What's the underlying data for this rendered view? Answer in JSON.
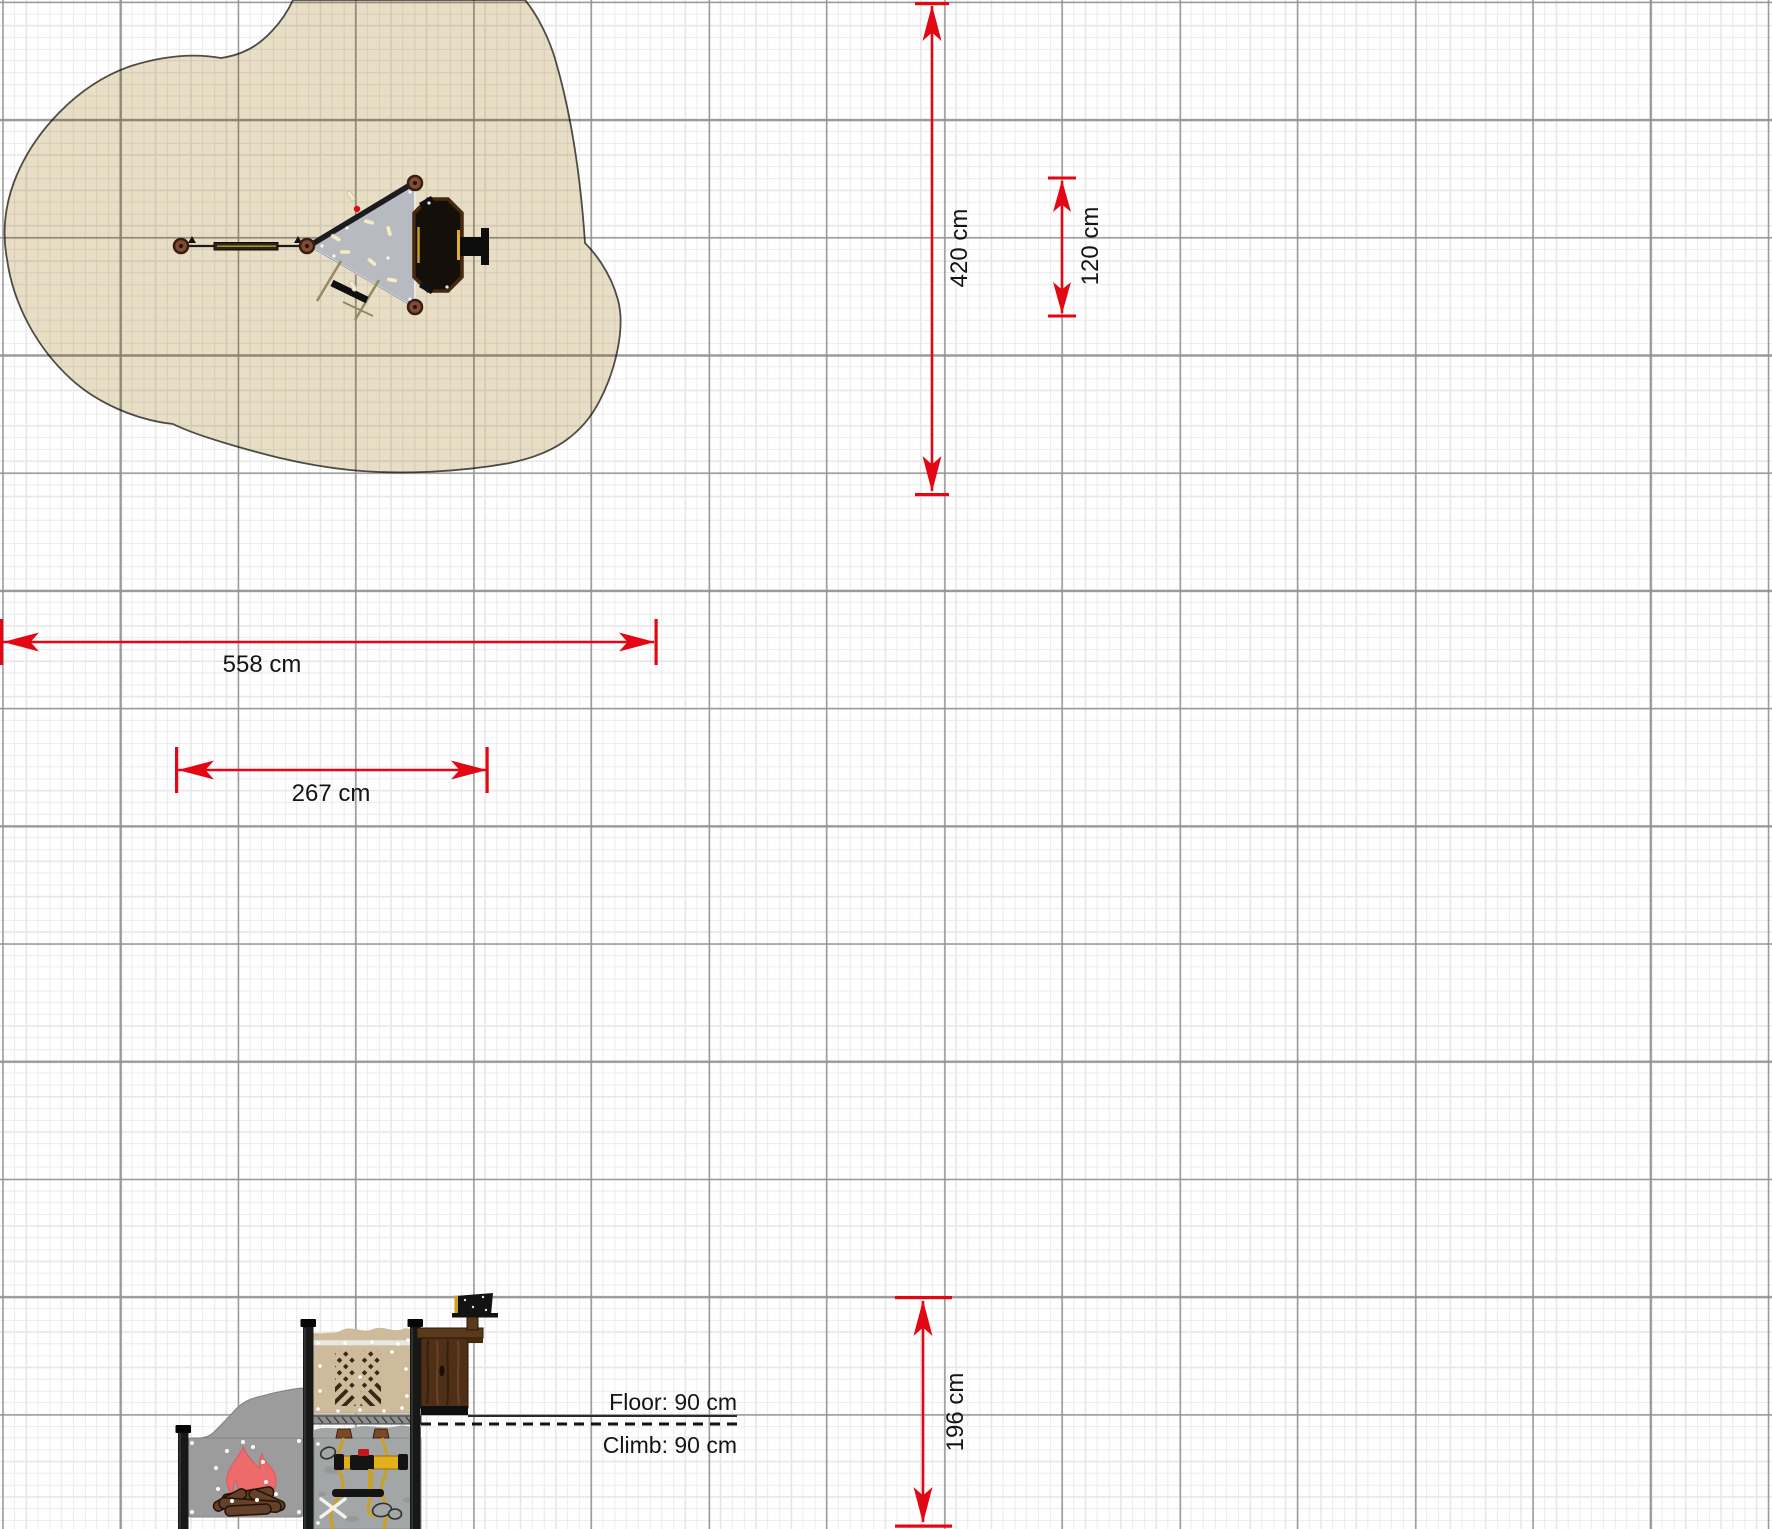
{
  "canvas": {
    "type": "playground-planner-drawing-canvas"
  },
  "colors": {
    "dimension_red": "#e30613",
    "safety_zone_fill": "#e8dec6",
    "grid_major": "#919191",
    "grid_minor": "#e7e7e7",
    "label_text": "#141414",
    "platform_gray": "#b7bbc1",
    "panel_tan": "#cdbb9c",
    "flame_coral": "#ee6b6c",
    "rope_yellow": "#c9a129"
  },
  "dims": {
    "d558": {
      "label": "558 cm",
      "orientation": "horizontal"
    },
    "d267": {
      "label": "267 cm",
      "orientation": "horizontal"
    },
    "d420": {
      "label": "420 cm",
      "orientation": "vertical"
    },
    "d120": {
      "label": "120 cm",
      "orientation": "vertical"
    },
    "d196": {
      "label": "196 cm",
      "orientation": "vertical"
    }
  },
  "levels": {
    "floor_label": "Floor: 90 cm",
    "climb_label": "Climb: 90 cm"
  }
}
